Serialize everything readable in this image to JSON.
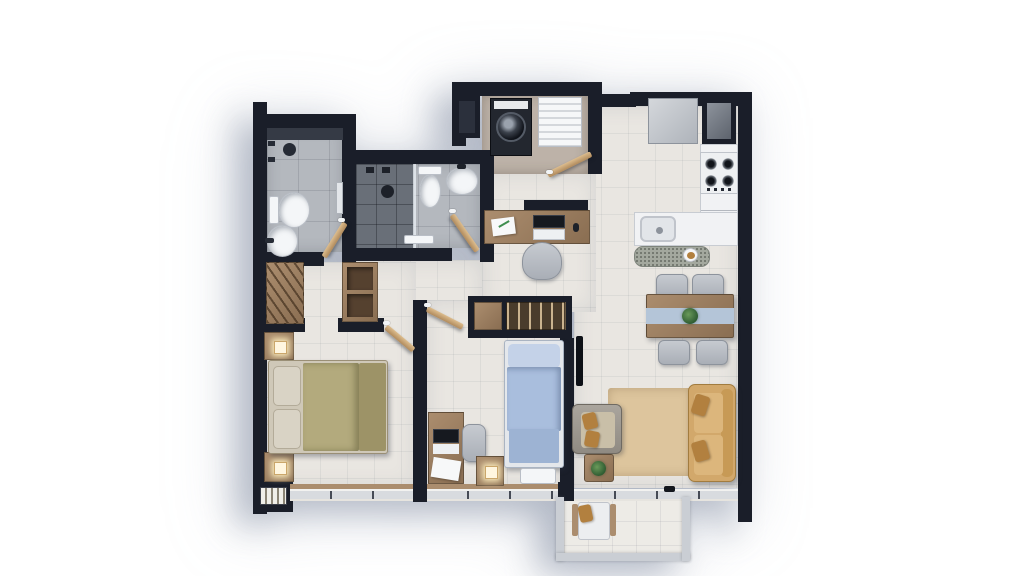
{
  "scene": {
    "kind": "apartment-floor-plan-3d-render",
    "view": "top-down",
    "background": "#ffffff",
    "shadow_direction": "lower-left"
  },
  "palette": {
    "wall": "#1a1e29",
    "wallInner": "#2b303c",
    "floorMain": "#e9e6e1",
    "floorBath": "#b4b8be",
    "floorShower": "#696f78",
    "floorBalcony": "#edebe6",
    "floorLaundry": "#bdb2a8",
    "fixture": "#f4f6f8",
    "wood": "#ab8d6e",
    "woodDark": "#8a6e52",
    "oliveBed": "#b3aa7d",
    "oliveDark": "#9d9367",
    "pillowBeige": "#d9d3c5",
    "blueBedLight": "#c4d2e8",
    "blueBed": "#a9bedd",
    "blueBedDeep": "#9db3d3",
    "sofaTan": "#d2a86b",
    "pillowTan": "#b2803f",
    "rug": "#ddc59d",
    "runnerBlue": "#b4c5d8",
    "granite": "#a3a89e",
    "railing": "#caced4",
    "applianceDark": "#23272f",
    "applianceGray": "#c3c7cc",
    "plantGreen": "#3f6e3f"
  },
  "rooms": [
    {
      "name": "master-bathroom",
      "floor": "gray-tile",
      "items": [
        "shower",
        "shower-head",
        "floor-drain",
        "toilet",
        "round-basin",
        "door"
      ]
    },
    {
      "name": "second-bathroom",
      "floor": "gray-tile",
      "items": [
        "dark-tile-shower",
        "shower-head",
        "glass-screen",
        "toilet",
        "round-basin",
        "bench",
        "door"
      ]
    },
    {
      "name": "laundry-closet",
      "items": [
        "washing-machine",
        "slatted-drying-rack",
        "service-shaft"
      ]
    },
    {
      "name": "kitchen",
      "items": [
        "refrigerator",
        "tall-dark-cabinet",
        "cooktop-4-burners",
        "counter-run",
        "counter-sink",
        "granite-island",
        "plate-of-food"
      ]
    },
    {
      "name": "dining-area",
      "items": [
        "wood-table",
        "blue-table-runner",
        "center-plant",
        "chair",
        "chair",
        "chair",
        "chair"
      ]
    },
    {
      "name": "living-room",
      "items": [
        "tan-sofa",
        "throw-pillow",
        "throw-pillow",
        "gray-armchair",
        "coffee-table",
        "potted-plant",
        "area-rug",
        "wall-tv"
      ]
    },
    {
      "name": "hall-study-nook",
      "items": [
        "desk",
        "laptop",
        "papers",
        "mouse",
        "desk-chair",
        "entry-door"
      ]
    },
    {
      "name": "master-bedroom",
      "items": [
        "double-bed-olive",
        "pillows",
        "nightstand-lamp",
        "nightstand-lamp",
        "open-wardrobe-hangers",
        "shelf-unit",
        "low-cabinet",
        "window-strip",
        "door"
      ]
    },
    {
      "name": "second-bedroom",
      "items": [
        "single-bed-blue",
        "foot-bench",
        "nightstand-lamp",
        "desk-with-laptop",
        "desk-chair",
        "built-in-wardrobe-hangers",
        "window-strip",
        "door"
      ]
    },
    {
      "name": "balcony",
      "items": [
        "lounge-chair",
        "railing",
        "sliding-door"
      ]
    }
  ]
}
